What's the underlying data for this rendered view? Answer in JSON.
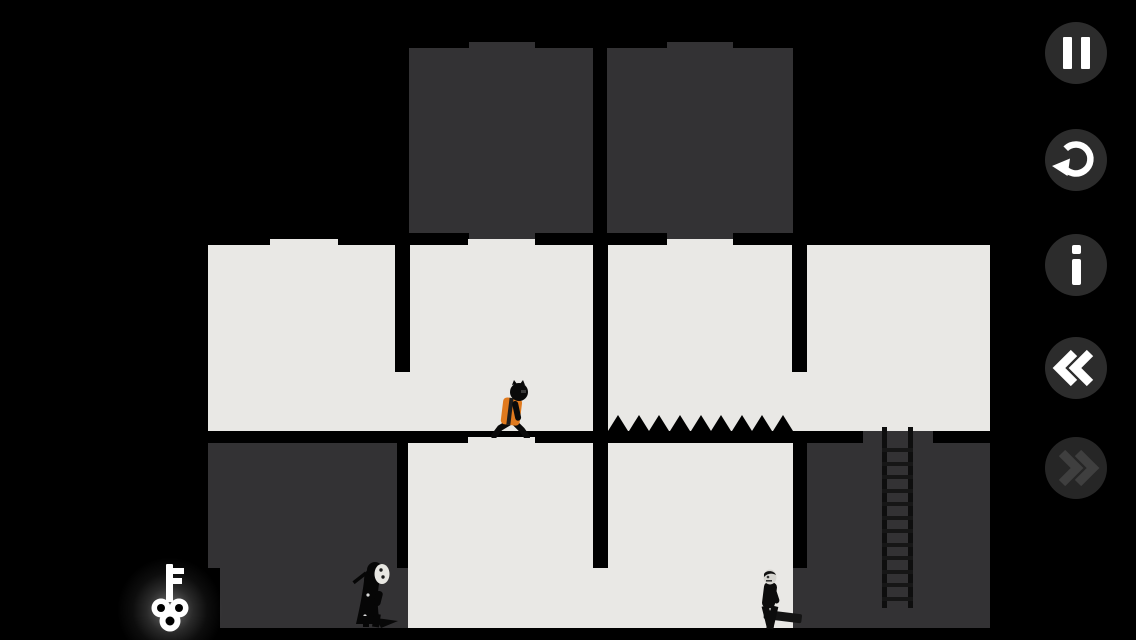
{
  "app": {
    "name": "puzzle-platformer-level"
  },
  "palette": {
    "bg": "#000000",
    "block_dark": "#333234",
    "block_light": "#e9e8e5",
    "vest_orange": "#e07a1e",
    "key_white": "#ffffff",
    "btn_circle": "#2c2c2c",
    "btn_circle_disabled": "#262626",
    "icon_white": "#ffffff",
    "icon_disabled": "#3f3f3f",
    "mask_white": "#e8e7e2",
    "head_gray": "#d6d5d0"
  },
  "hud": {
    "buttons": [
      {
        "id": "pause",
        "icon": "pause-icon",
        "enabled": true
      },
      {
        "id": "restart",
        "icon": "restart-icon",
        "enabled": true
      },
      {
        "id": "info",
        "icon": "info-icon",
        "enabled": true
      },
      {
        "id": "rewind",
        "icon": "rewind-icon",
        "enabled": true
      },
      {
        "id": "fast-forward",
        "icon": "fast-forward-icon",
        "enabled": false
      }
    ]
  },
  "level": {
    "player": {
      "type": "worker",
      "vest_color": "#e07a1e",
      "facing": "right",
      "state": "walking"
    },
    "enemies": [
      {
        "type": "masked-reaper",
        "mask_color": "#e8e7e2",
        "facing": "right"
      },
      {
        "type": "club-carrier",
        "head_color": "#d6d5d0",
        "facing": "left"
      }
    ],
    "pickups": [
      {
        "type": "key",
        "color": "#ffffff",
        "glow": true
      }
    ],
    "hazards": [
      {
        "type": "spikes",
        "count": 9
      }
    ],
    "props": [
      {
        "type": "ladder",
        "rungs": 12
      }
    ]
  }
}
